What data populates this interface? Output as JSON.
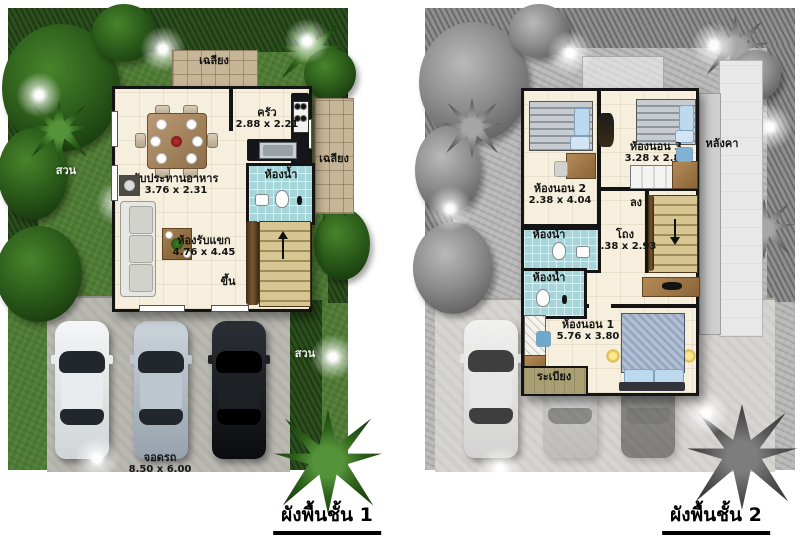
{
  "floor1": {
    "caption": "ผังพื้นชั้น 1",
    "garden_left": "สวน",
    "garden_right": "สวน",
    "porch_top": "เฉลียง",
    "porch_right": "เฉลียง",
    "kitchen": {
      "name": "ครัว",
      "size": "2.88 x 2.21"
    },
    "dining": {
      "name": "รับประทานอาหาร",
      "size": "3.76 x 2.31"
    },
    "bathroom": {
      "name": "ห้องน้ำ"
    },
    "living": {
      "name": "ห้องรับแขก",
      "size": "4.76 x 4.45"
    },
    "stairs": {
      "label": "ขึ้น"
    },
    "parking": {
      "name": "จอดรถ",
      "size": "8.50 x 6.00"
    }
  },
  "floor2": {
    "caption": "ผังพื้นชั้น 2",
    "bedroom2": {
      "name": "ห้องนอน 2",
      "size": "2.38 x 4.04"
    },
    "bedroom3": {
      "name": "ห้องนอน 3",
      "size": "3.28 x 2.84"
    },
    "roof": {
      "name": "หลังคา"
    },
    "stairs": {
      "label": "ลง"
    },
    "hall": {
      "name": "โถง",
      "size": "2.38 x 2.93"
    },
    "bathroom_upper": {
      "name": "ห้องน้ำ"
    },
    "bathroom_lower": {
      "name": "ห้องน้ำ"
    },
    "bedroom1": {
      "name": "ห้องนอน 1",
      "size": "5.76 x 3.80"
    },
    "balcony": {
      "name": "ระเบียง"
    }
  },
  "colors": {
    "lawn": "#4e7b33",
    "hedge": "#2b4f1d",
    "concrete": "#b9b8b1",
    "floor": "#f6efdd",
    "porch_tile": "#c7b597",
    "bathroom_tile": "#a6d6da",
    "stair_wood": "#d7c592",
    "wall": "#141414",
    "gray_lawn": "#b9b9b9",
    "gray_concrete": "#d6d5d1",
    "bed_blue": "#bcd9ee",
    "car_white": "#f4f6f7",
    "car_silver": "#ccd4db",
    "car_black": "#0b0d10"
  }
}
